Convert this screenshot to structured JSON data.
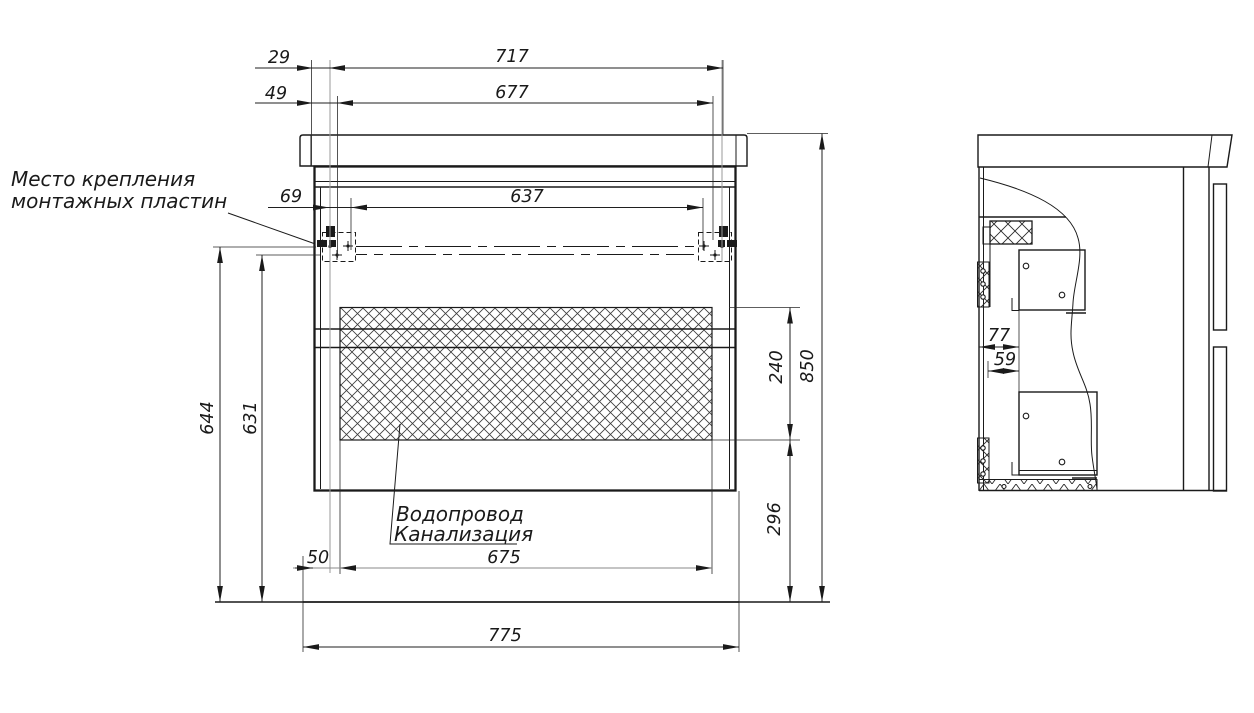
{
  "drawing": {
    "labels": {
      "mounting_note_line1": "Место крепления",
      "mounting_note_line2": "монтажных пластин",
      "plumbing_note_line1": "Водопровод",
      "plumbing_note_line2": "Канализация"
    },
    "front_view": {
      "dims": {
        "top_offset_small": "29",
        "top_offset_large": "49",
        "top_width_outer": "717",
        "top_width_inner": "677",
        "bracket_offset": "69",
        "bracket_span": "637",
        "height_to_bracket_outer": "644",
        "height_to_bracket_inner": "631",
        "service_zone_height": "240",
        "overall_height": "850",
        "zone_bottom_height": "296",
        "zone_left_offset": "50",
        "service_zone_width": "675",
        "overall_width": "775"
      }
    },
    "side_view": {
      "dims": {
        "back_clearance": "77",
        "rail_clearance": "59"
      }
    },
    "colors": {
      "line": "#1a1a1a",
      "gray_line": "#9a9a9a",
      "background": "#ffffff"
    }
  }
}
